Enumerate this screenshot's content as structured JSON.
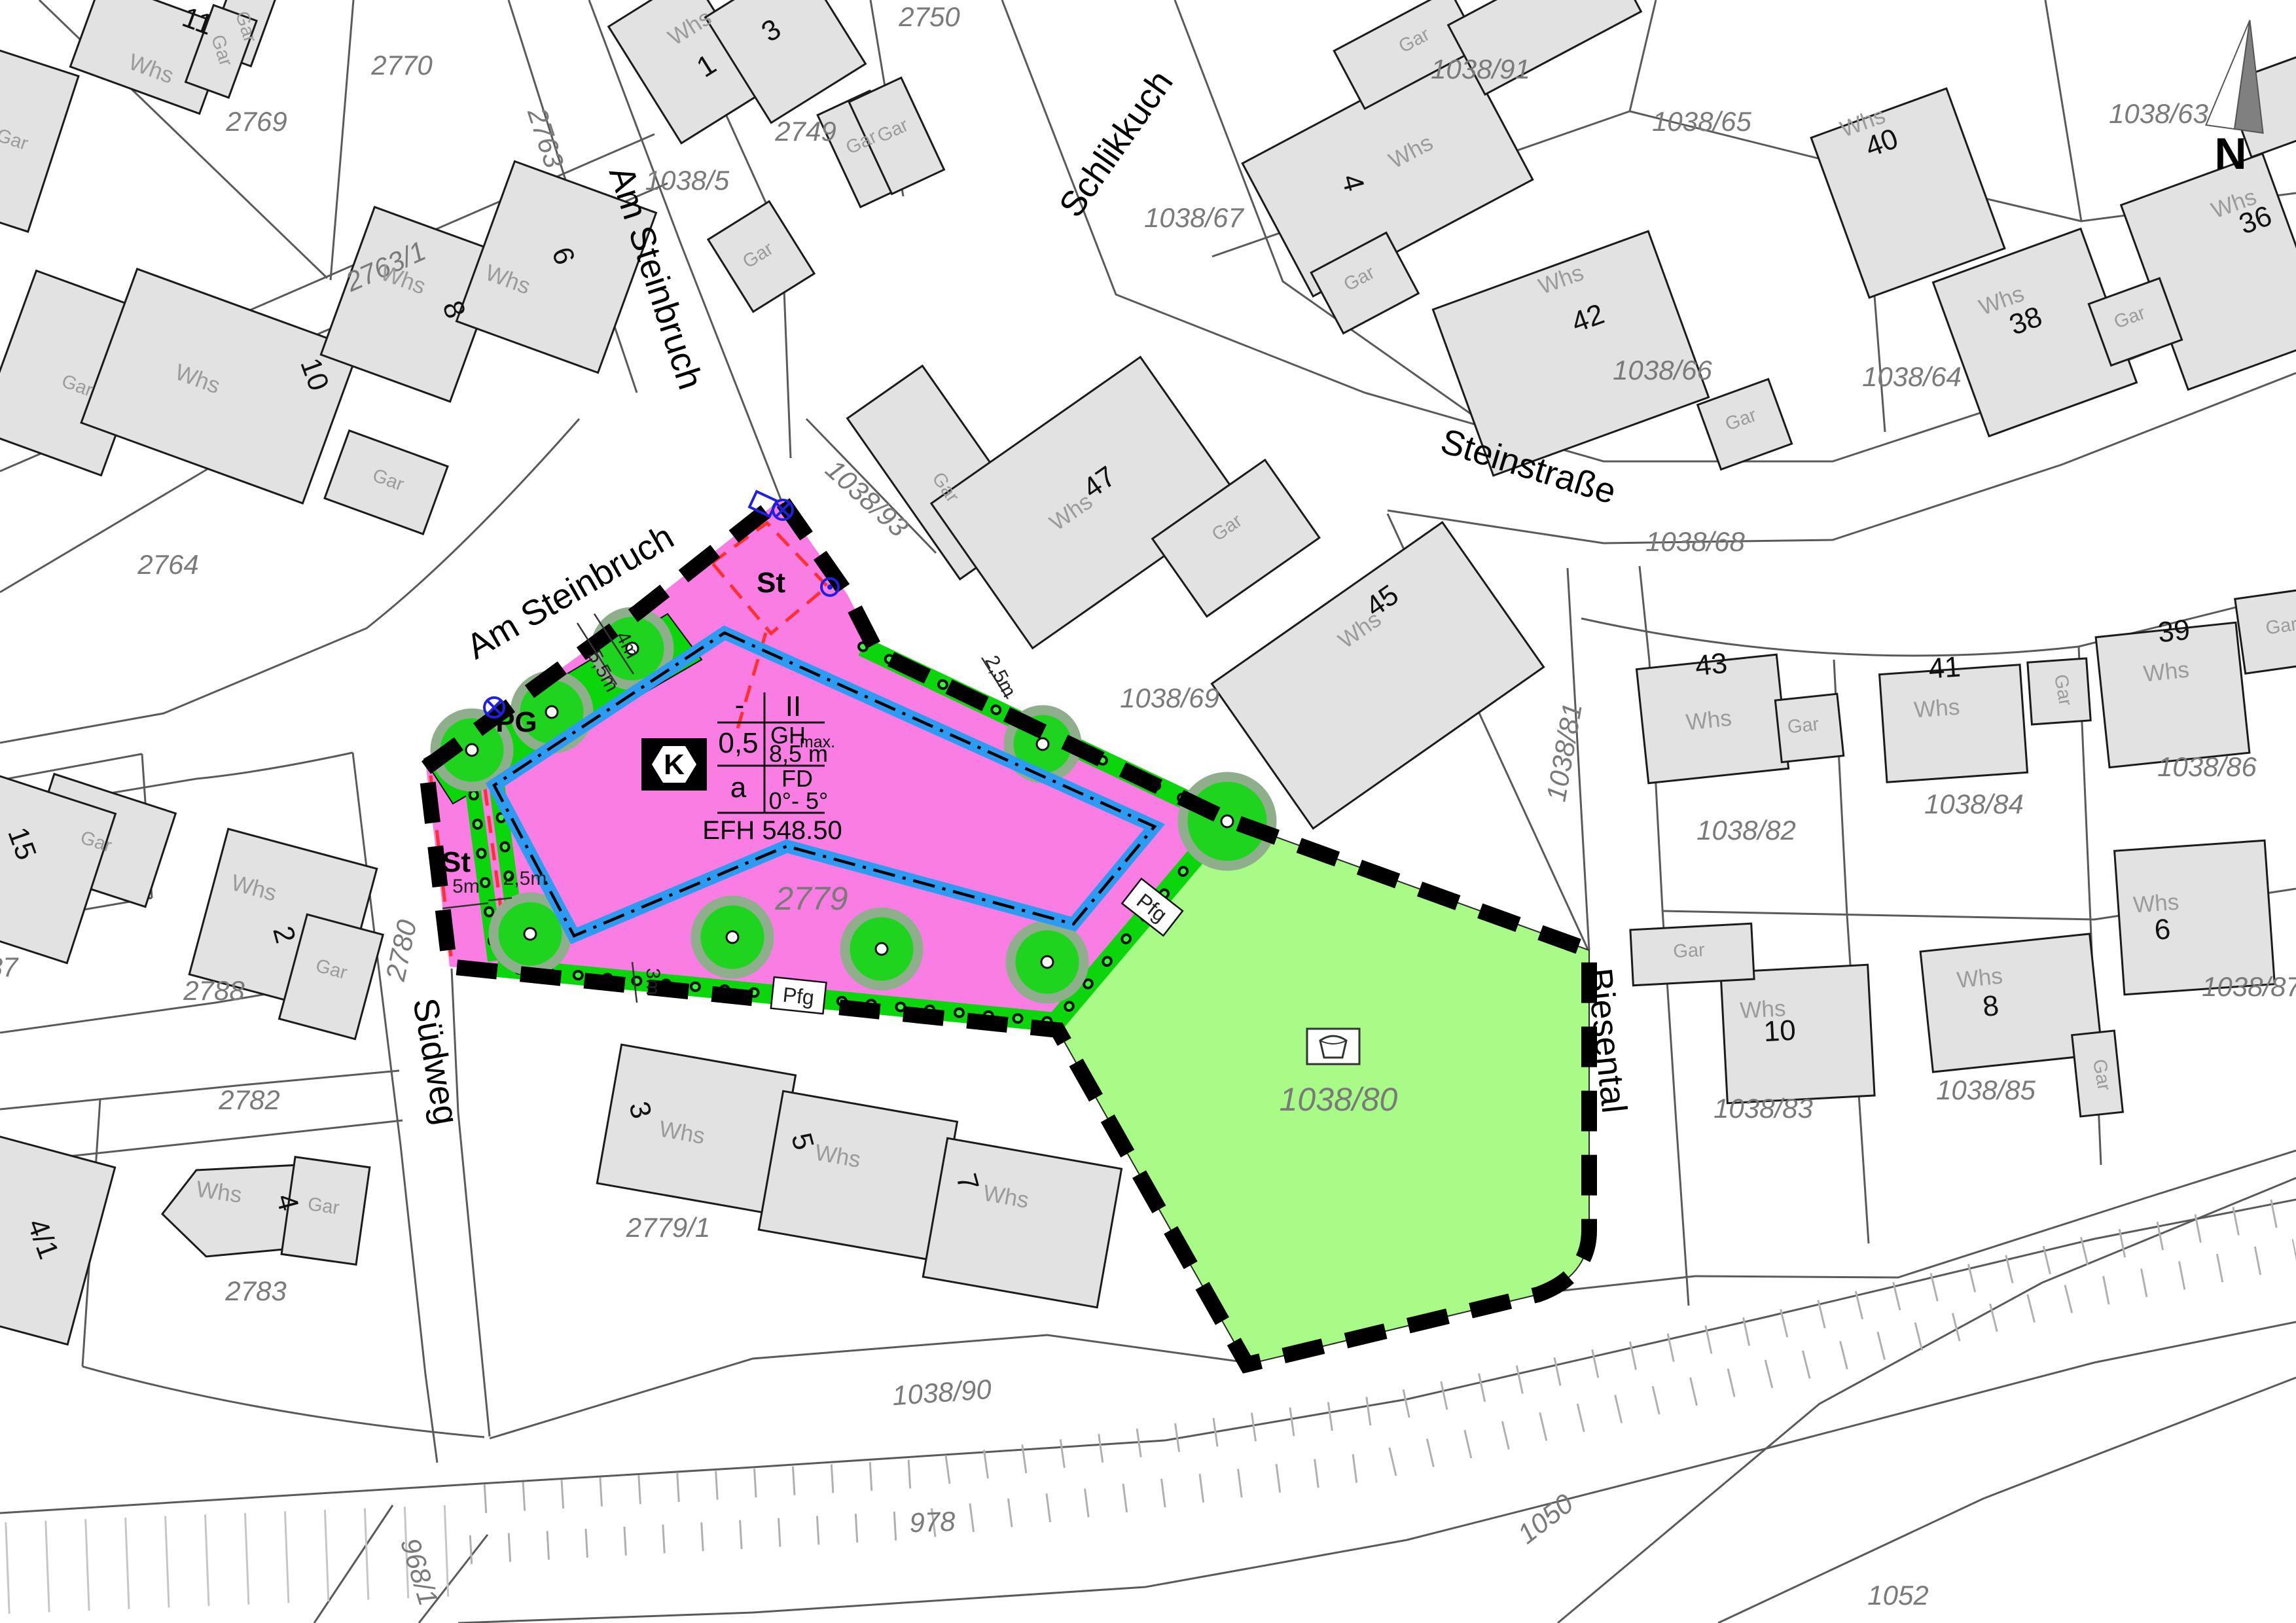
{
  "map_title": "Bebauungsplan Auszug",
  "colors": {
    "pink_zone": "#F97DE2",
    "green_strip": "#0BD50B",
    "green_area": "#A8FB87",
    "blue_envelope": "#2E9BF2",
    "red_dash": "#FF3030",
    "boundary": "#000000",
    "building_fill": "#E2E2E2"
  },
  "streets": {
    "am_steinbruch_upper": "Am Steinbruch",
    "am_steinbruch_lower": "Am Steinbruch",
    "schlikkuch": "Schlikkuch",
    "steinstrasse": "Steinstraße",
    "suedweg": "Südweg",
    "biesental": "Biesental"
  },
  "compass": {
    "n": "N"
  },
  "parcels": {
    "p2770": "2770",
    "p2769": "2769",
    "p2763_1": "2763/1",
    "p2763": "2763",
    "p1038_5": "1038/5",
    "p2749": "2749",
    "p2750": "2750",
    "p1038_91": "1038/91",
    "p1038_67": "1038/67",
    "p1038_65": "1038/65",
    "p1038_63": "1038/63",
    "p1038_66": "1038/66",
    "p1038_64": "1038/64",
    "p1038_68": "1038/68",
    "p1038_69": "1038/69",
    "p1038_93": "1038/93",
    "p2764": "2764",
    "p1038_81": "1038/81",
    "p1038_82": "1038/82",
    "p1038_84": "1038/84",
    "p1038_86": "1038/86",
    "p1038_87": "1038/87",
    "p1038_85": "1038/85",
    "p1038_83": "1038/83",
    "p1038_80": "1038/80",
    "p2779": "2779",
    "p2779_1": "2779/1",
    "p2788": "2788",
    "p2782": "2782",
    "p2780": "2780",
    "p2783": "2783",
    "p1038_90": "1038/90",
    "p978": "978",
    "p1050": "1050",
    "p1052": "1052",
    "p968_1": "968/1",
    "p87": "87"
  },
  "houses": {
    "n11": "11",
    "n1": "1",
    "n3": "3",
    "n6": "6",
    "n8": "8",
    "n10": "10",
    "n4": "4",
    "n42": "42",
    "n40": "40",
    "n36": "36",
    "n38": "38",
    "n47": "47",
    "n45": "45",
    "n43": "43",
    "n41": "41",
    "n39": "39",
    "n6e": "6",
    "n8e": "8",
    "n10e": "10",
    "n2": "2",
    "n3s": "3",
    "n5": "5",
    "n7": "7",
    "n4s": "4",
    "n4_1": "4/1",
    "n15": "15"
  },
  "bld": {
    "whs": "Whs",
    "gar": "Gar"
  },
  "plan": {
    "st": "St",
    "pg": "PG",
    "pfg": "Pfg",
    "k": "K",
    "t_dash": "-",
    "t_ii": "II",
    "t_05": "0,5",
    "t_gh": "GH",
    "t_ghsub": "max.",
    "t_ghval": "8,5 m",
    "t_a": "a",
    "t_fd": "FD",
    "t_fdval": "0°- 5°",
    "t_efh": "EFH 548.50",
    "d5": "5m",
    "d25": "2,5m",
    "d3": "3m",
    "d4": "4m",
    "d55": "5,5m",
    "d25e": "2,5m"
  }
}
